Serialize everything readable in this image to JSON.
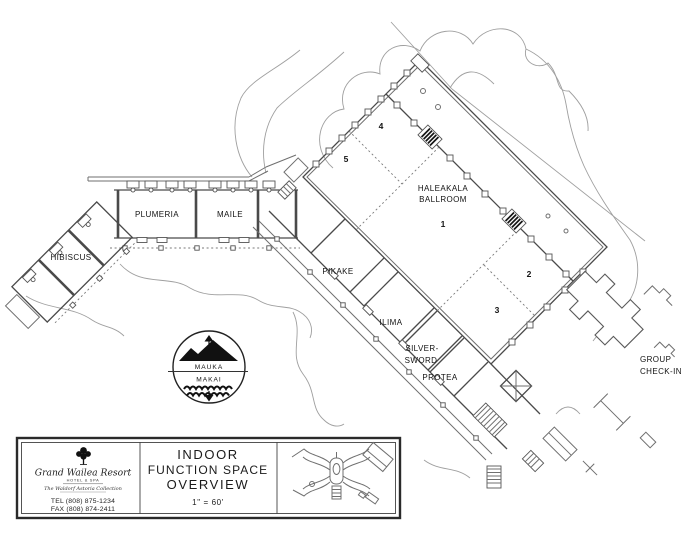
{
  "plan": {
    "rooms": {
      "hibiscus": "HIBISCUS",
      "plumeria": "PLUMERIA",
      "maile": "MAILE",
      "pikake": "PIKAKE",
      "ilima": "ILIMA",
      "silversword_line1": "SILVER-",
      "silversword_line2": "SWORD",
      "protea": "PROTEA",
      "haleakala_line1": "HALEAKALA",
      "haleakala_line2": "BALLROOM",
      "group_checkin_line1": "GROUP",
      "group_checkin_line2": "CHECK-IN"
    },
    "sections": {
      "s1": "1",
      "s2": "2",
      "s3": "3",
      "s4": "4",
      "s5": "5"
    }
  },
  "compass": {
    "mauka": "MAUKA",
    "makai": "MAKAI",
    "top_icon": "mountain-silhouette",
    "bottom_icon": "ocean-waves"
  },
  "title_block": {
    "logo": {
      "tree_icon": "tree-icon",
      "name": "Grand Wailea Resort",
      "subtitle": "HOTEL & SPA",
      "collection": "The Waldorf Astoria Collection",
      "tel": "TEL (808) 875-1234",
      "fax": "FAX (808) 874-2411"
    },
    "title_line1": "INDOOR",
    "title_line2": "FUNCTION SPACE",
    "title_line3": "OVERVIEW",
    "scale": "1\" = 60'"
  },
  "colors": {
    "background": "#ffffff",
    "wall_line": "#4a4a4a",
    "landscape_line": "#9f9f9f",
    "text": "#131313"
  }
}
